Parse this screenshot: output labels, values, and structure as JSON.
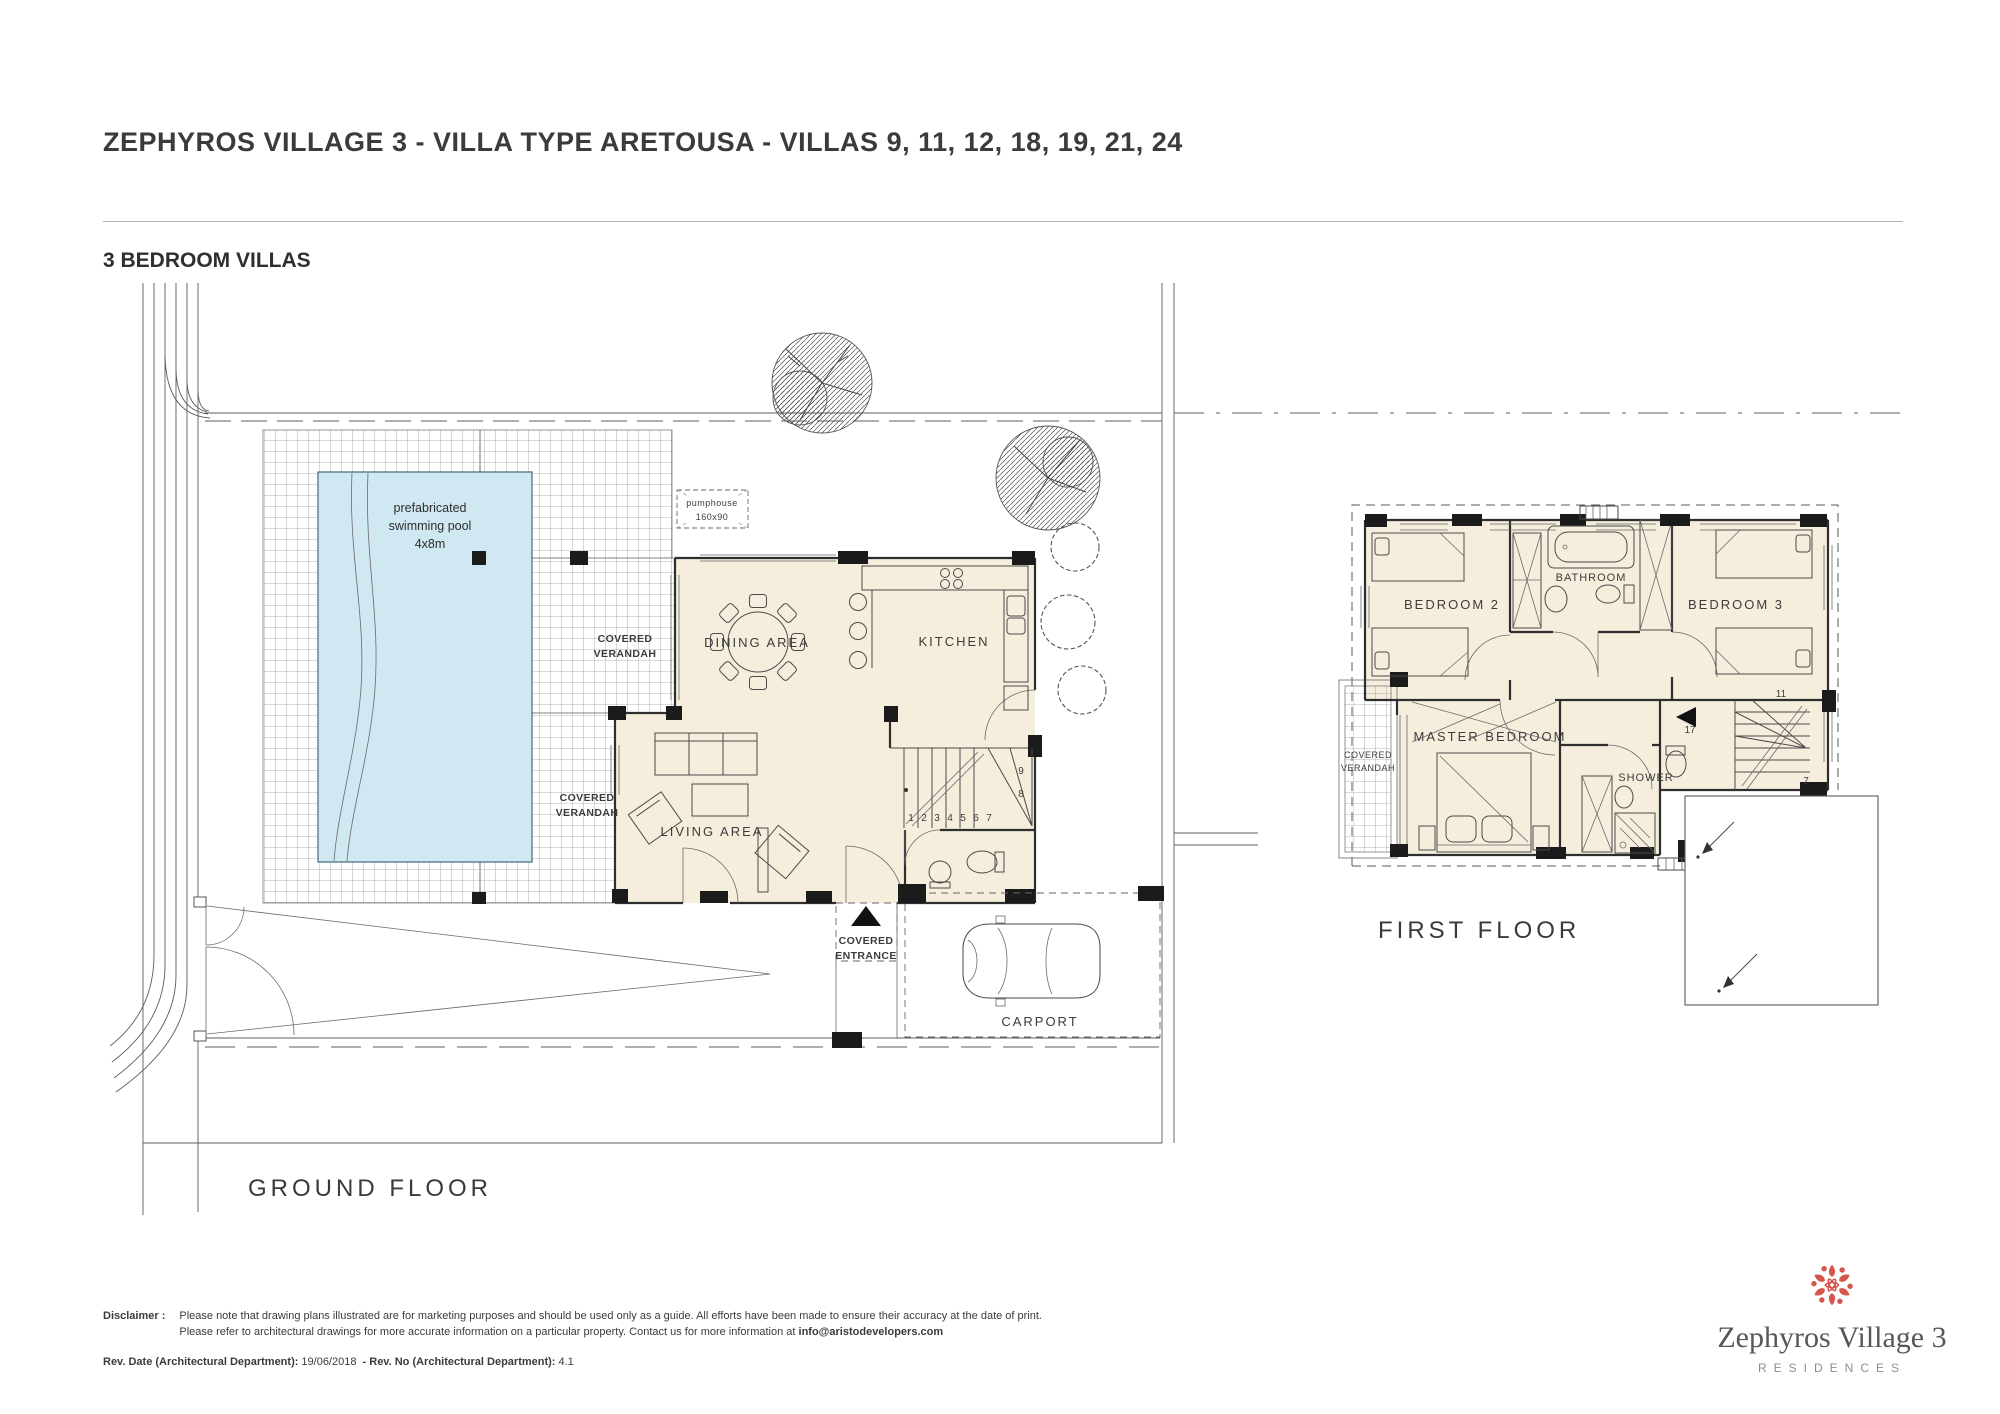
{
  "header": {
    "title": "ZEPHYROS VILLAGE 3 - VILLA TYPE ARETOUSA - VILLAS  9, 11, 12, 18, 19, 21, 24",
    "subtitle": "3 BEDROOM VILLAS"
  },
  "ground_floor": {
    "name": "GROUND FLOOR",
    "labels": {
      "pool_line1": "prefabricated",
      "pool_line2": "swimming pool",
      "pool_line3": "4x8m",
      "pumphouse_line1": "pumphouse",
      "pumphouse_line2": "160x90",
      "covered_verandah_line1": "COVERED",
      "covered_verandah_line2": "VERANDAH",
      "dining_area": "DINING  AREA",
      "kitchen": "KITCHEN",
      "living_area": "LIVING  AREA",
      "covered_entrance_line1": "COVERED",
      "covered_entrance_line2": "ENTRANCE",
      "carport": "CARPORT",
      "stair_numbers": [
        "1",
        "2",
        "3",
        "4",
        "5",
        "6",
        "7",
        "8",
        "9"
      ]
    }
  },
  "first_floor": {
    "name": "FIRST FLOOR",
    "labels": {
      "bedroom2": "BEDROOM 2",
      "bathroom": "BATHROOM",
      "bedroom3": "BEDROOM 3",
      "master_bedroom": "MASTER BEDROOM",
      "shower": "SHOWER",
      "covered_verandah_line1": "COVERED",
      "covered_verandah_line2": "VERANDAH",
      "stair_numbers": [
        "17",
        "11",
        "7"
      ]
    }
  },
  "footer": {
    "disclaimer_label": "Disclaimer :",
    "disclaimer_line1": "Please note that drawing plans illustrated are for marketing purposes and should be used only as a guide. All efforts have been made to ensure their accuracy at the date of print.",
    "disclaimer_line2_pre": "Please refer to architectural drawings for more accurate information on a particular property. Contact us for more information at ",
    "disclaimer_email": "info@aristodevelopers.com",
    "rev_label1": "Rev. Date (Architectural Department):",
    "rev_value1": "19/06/2018",
    "rev_sep": "- Rev. No (Architectural Department):",
    "rev_value2": "4.1"
  },
  "logo": {
    "line1": "Zephyros Village 3",
    "line2": "RESIDENCES"
  },
  "colors": {
    "room_fill": "#f6eedd",
    "pool_fill": "#cfe8f1",
    "wall_black": "#1b1b1b",
    "line_gray": "#4a4a4a",
    "text_gray": "#3b3b3b",
    "logo_red": "#d5544c",
    "logo_gray": "#575757"
  }
}
